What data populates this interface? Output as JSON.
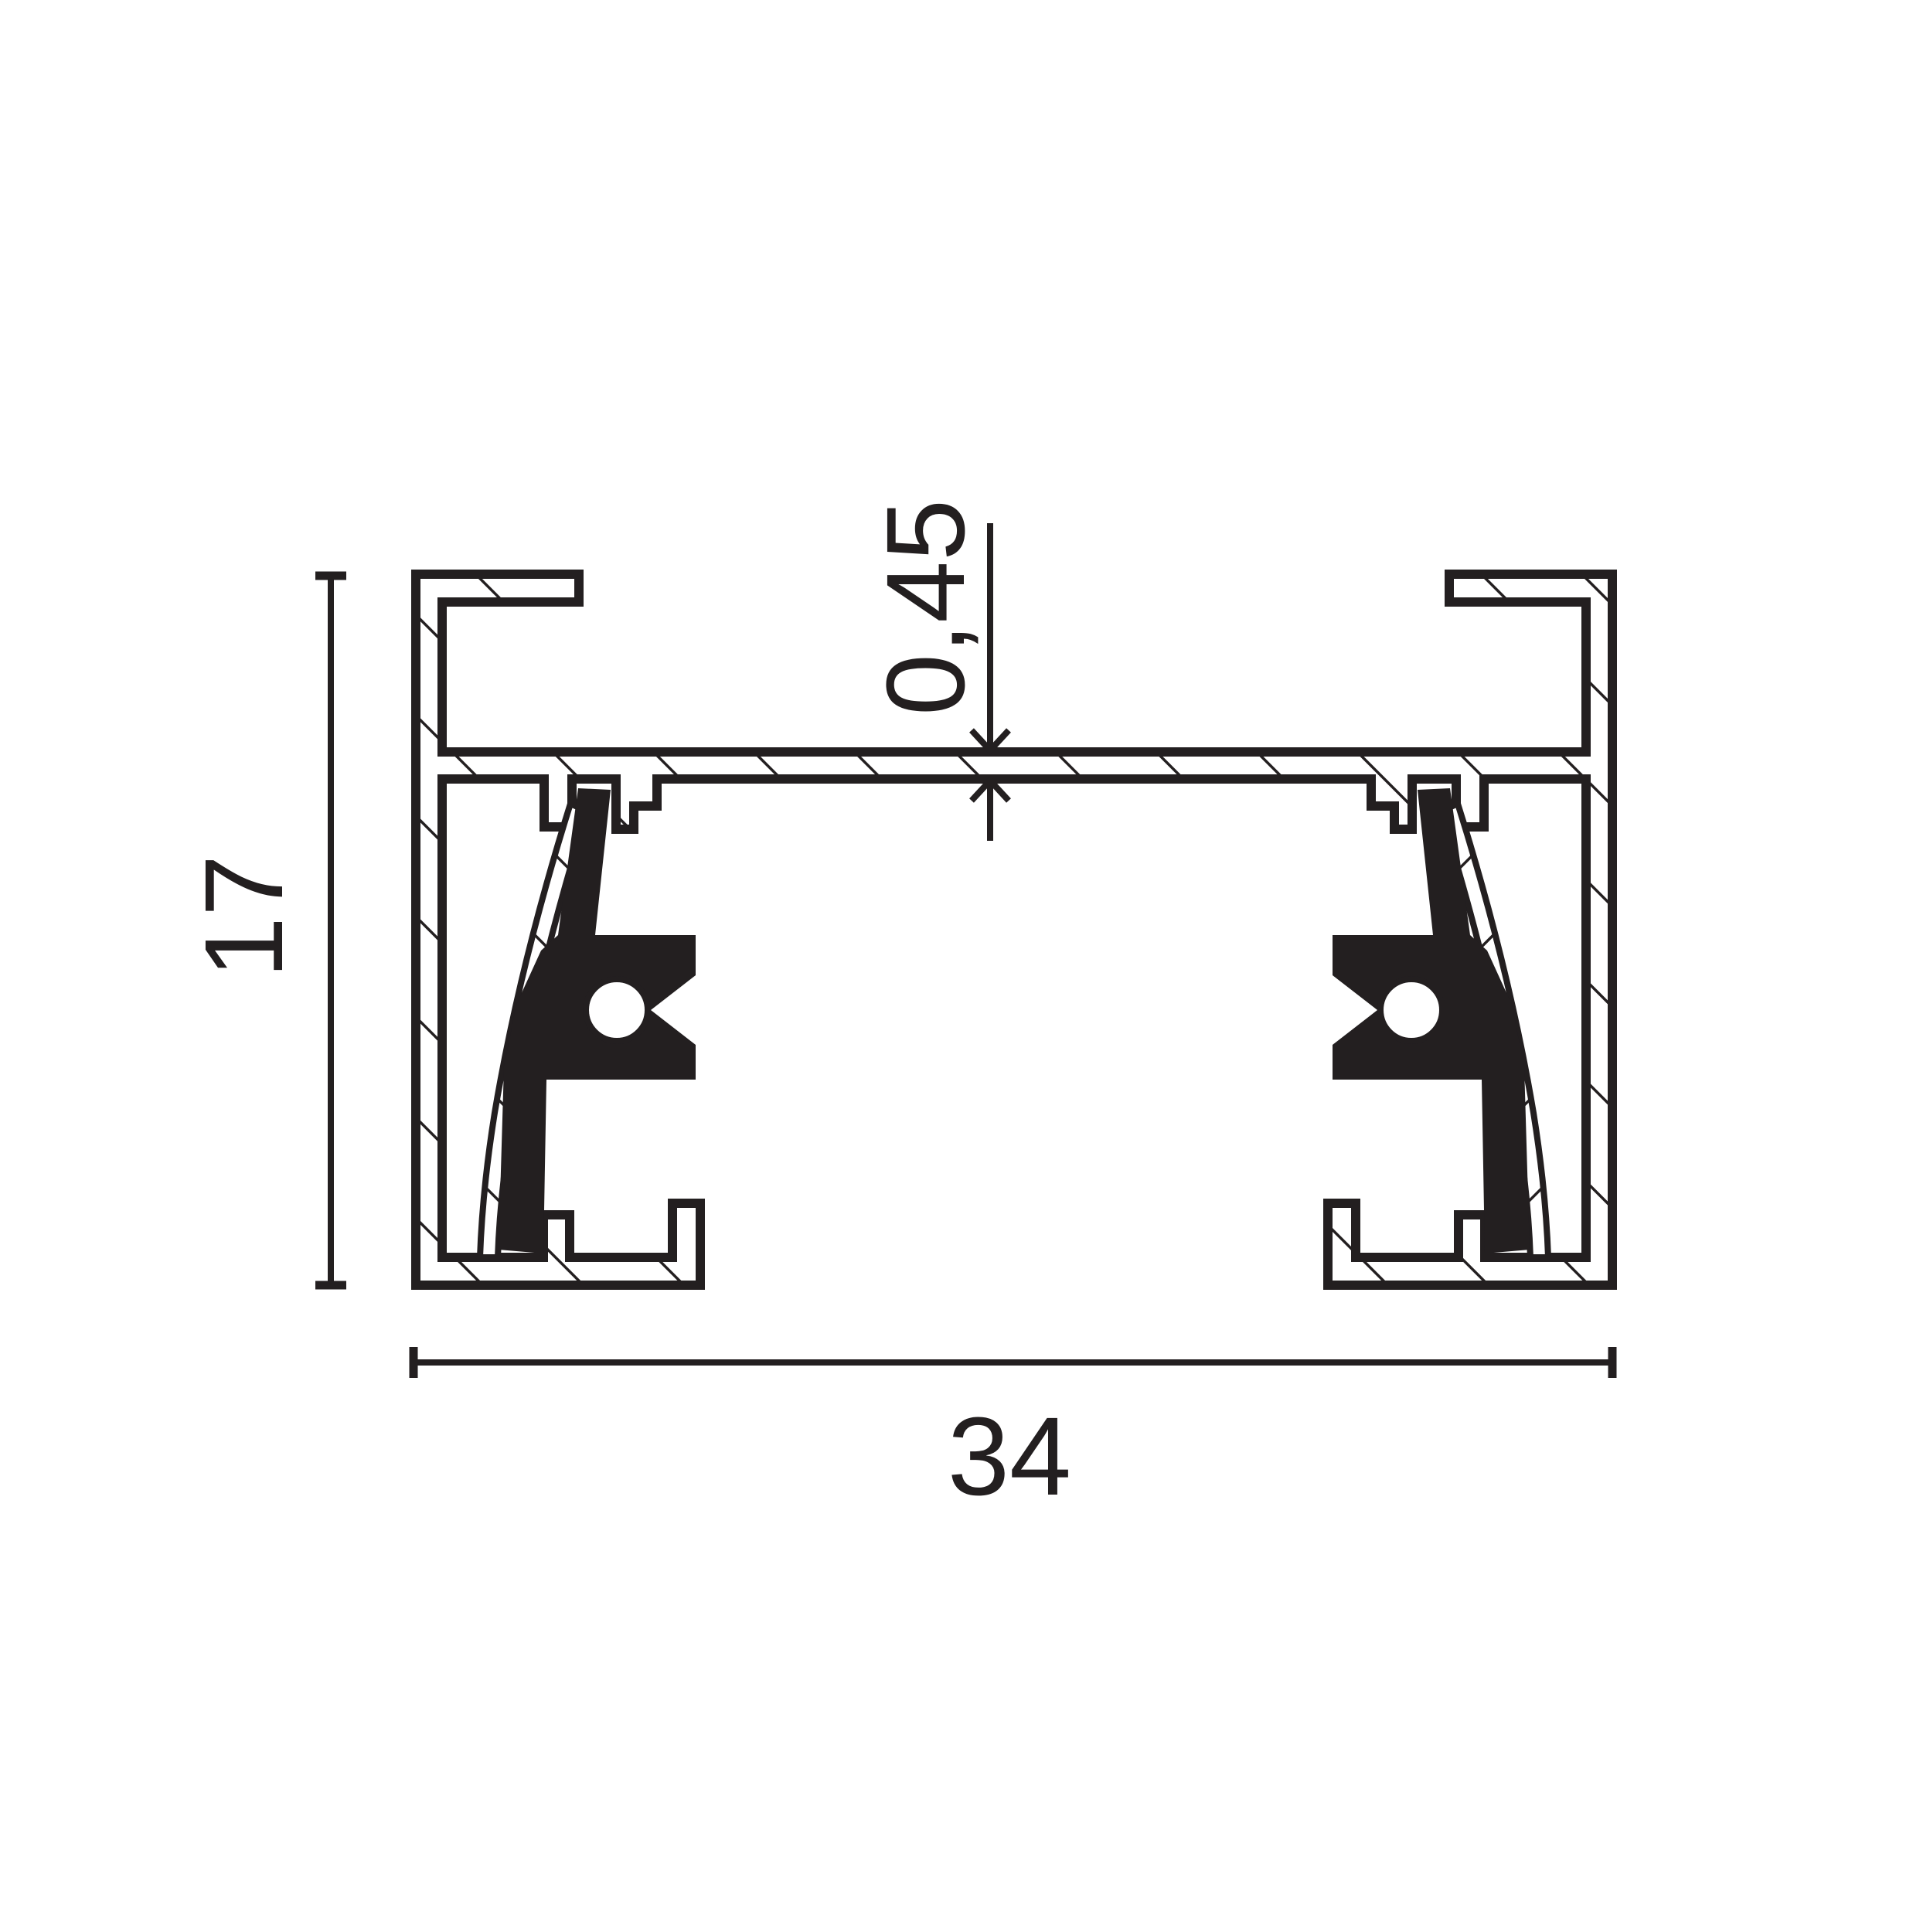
{
  "drawing": {
    "title": "track-profile-cross-section",
    "background": "#ffffff",
    "ink": "#231f20",
    "dimensions": {
      "height": {
        "value": "17",
        "orientation": "vertical",
        "side": "left"
      },
      "width": {
        "value": "34",
        "orientation": "horizontal",
        "side": "bottom"
      },
      "thickness": {
        "value": "0,45",
        "orientation": "vertical",
        "side": "top-center"
      }
    }
  }
}
